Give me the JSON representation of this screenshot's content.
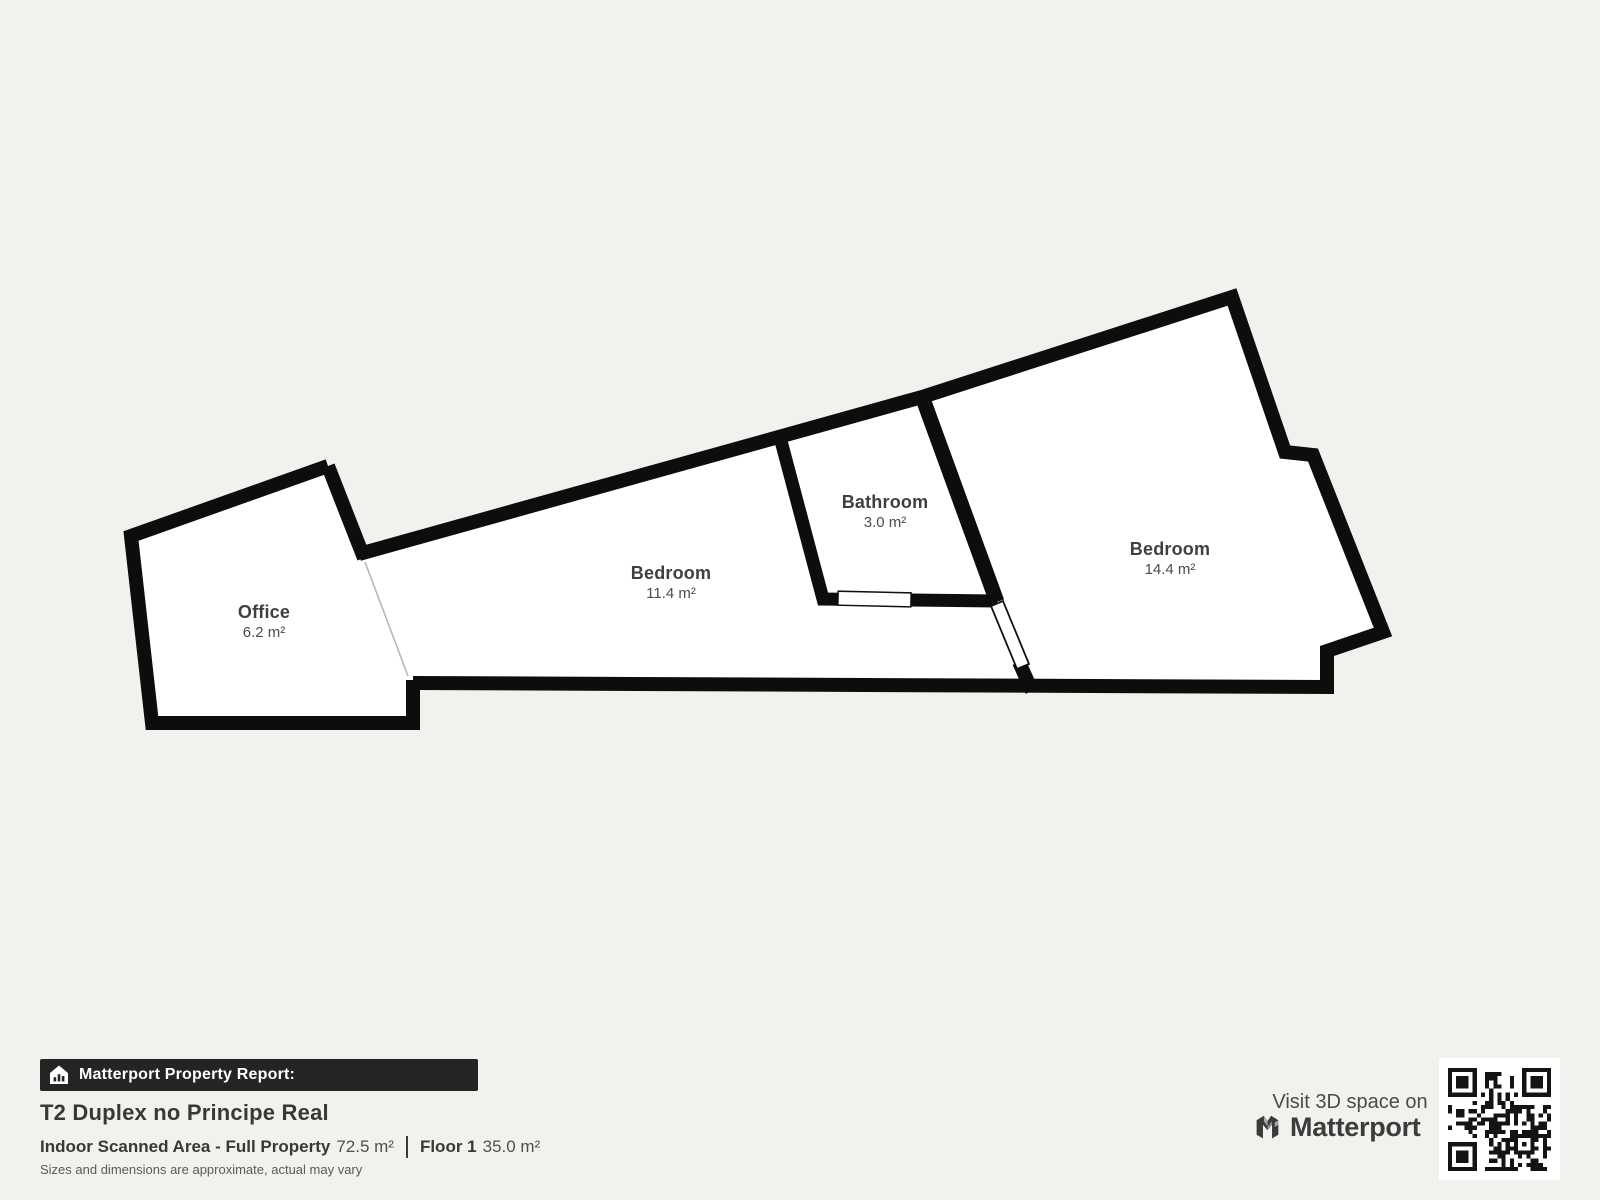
{
  "floorplan": {
    "rooms": [
      {
        "name": "Office",
        "area": "6.2 m²"
      },
      {
        "name": "Bedroom",
        "area": "11.4 m²"
      },
      {
        "name": "Bathroom",
        "area": "3.0 m²"
      },
      {
        "name": "Bedroom",
        "area": "14.4 m²"
      }
    ]
  },
  "report": {
    "banner_label": "Matterport Property Report:",
    "title": "T2 Duplex no Principe Real",
    "area_label": "Indoor Scanned Area - Full Property",
    "area_value": "72.5 m²",
    "floor_label": "Floor 1",
    "floor_value": "35.0 m²",
    "disclaimer": "Sizes and dimensions are approximate, actual may vary"
  },
  "promo": {
    "visit_text": "Visit 3D space on",
    "brand": "Matterport",
    "qr_icon": "qr-code"
  },
  "colors": {
    "bg": "#f2f1ee",
    "floor": "#ffffff",
    "wall": "#0d0d0d",
    "banner": "#242424",
    "divider_line": "#b3b3b3"
  }
}
